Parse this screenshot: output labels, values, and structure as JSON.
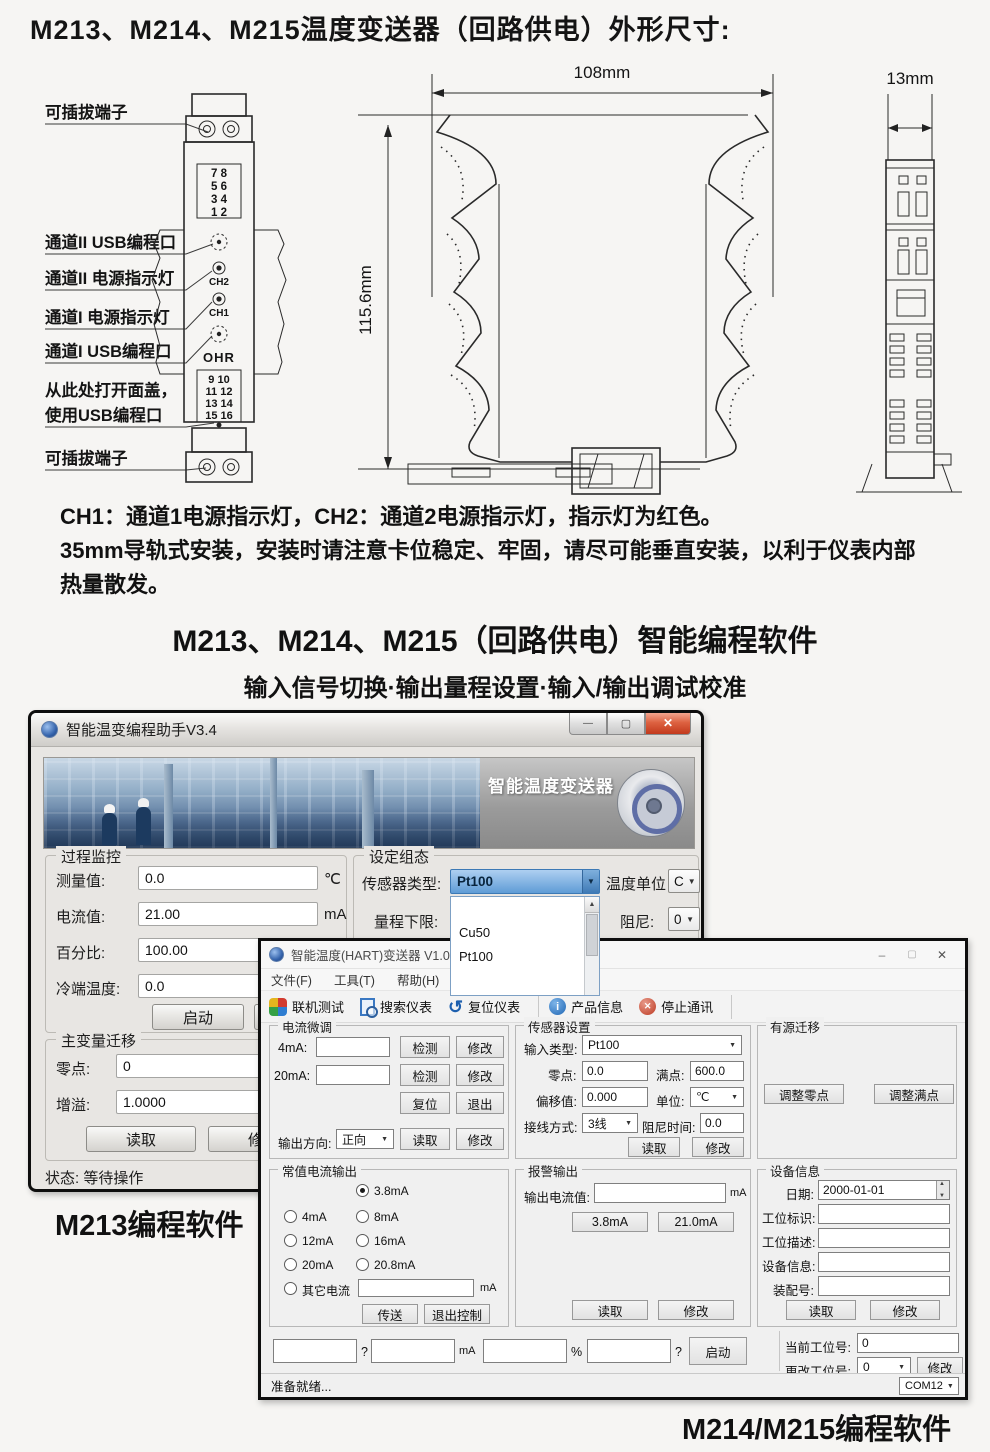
{
  "page": {
    "title": "M213、M214、M215温度变送器（回路供电）外形尺寸:",
    "note_line1": "CH1：通道1电源指示灯，CH2：通道2电源指示灯，指示灯为红色。",
    "note_line2": "35mm导轨式安装，安装时请注意卡位稳定、牢固，请尽可能垂直安装，以利于仪表内部",
    "note_line3": "热量散发。",
    "section_title": "M213、M214、M215（回路供电）智能编程软件",
    "section_subtitle": "输入信号切换·输出量程设置·输入/输出调试校准",
    "caption_m213": "M213编程软件",
    "caption_m214": "M214/M215编程软件"
  },
  "diagram": {
    "labels": {
      "plug_top": "可插拔端子",
      "ch2_usb": "通道II USB编程口",
      "ch2_led": "通道II 电源指示灯",
      "ch1_led": "通道I 电源指示灯",
      "ch1_usb": "通道I USB编程口",
      "cover1": "从此处打开面盖，",
      "cover2": "使用USB编程口",
      "plug_bottom": "可插拔端子"
    },
    "device": {
      "terms_top": [
        "7  8",
        "5  6",
        "3  4",
        "1  2"
      ],
      "ch2": "CH2",
      "ch1": "CH1",
      "logo": "OHR",
      "terms_bottom": [
        "9  10",
        "11 12",
        "13 14",
        "15 16"
      ]
    },
    "dims": {
      "width": "108mm",
      "height": "115.6mm",
      "side": "13mm"
    }
  },
  "win1": {
    "title": "智能温变编程助手V3.4",
    "banner_label": "智能温度变送器",
    "process": {
      "title": "过程监控",
      "rows": [
        {
          "label": "测量值:",
          "value": "0.0",
          "unit": "℃"
        },
        {
          "label": "电流值:",
          "value": "21.00",
          "unit": "mA"
        },
        {
          "label": "百分比:",
          "value": "100.00",
          "unit": "%"
        },
        {
          "label": "冷端温度:",
          "value": "0.0",
          "unit": ""
        }
      ],
      "start": "启动",
      "stop": "停止"
    },
    "config": {
      "title": "设定组态",
      "sensor_label": "传感器类型:",
      "sensor_value": "Pt100",
      "temp_unit_label": "温度单位",
      "temp_unit_value": "C",
      "range_label": "量程下限:",
      "damping_label": "阻尼:",
      "damping_value": "0",
      "list_items": [
        "",
        "Cu50",
        "Pt100"
      ]
    },
    "shift": {
      "title": "主变量迁移",
      "zero_label": "零点:",
      "zero_value": "0",
      "gain_label": "增溢:",
      "gain_value": "1.0000",
      "read": "读取",
      "modify": "修改"
    },
    "status": "状态: 等待操作"
  },
  "win2": {
    "title": "智能温度(HART)变送器 V1.05 (2017-04-07)",
    "menus": [
      "文件(F)",
      "工具(T)",
      "帮助(H)"
    ],
    "toolbar": [
      "联机测试",
      "搜索仪表",
      "复位仪表",
      "产品信息",
      "停止通讯"
    ],
    "trim": {
      "title": "电流微调",
      "l4": "4mA:",
      "l20": "20mA:",
      "detect": "检测",
      "modify": "修改",
      "reset": "复位",
      "exit": "退出",
      "dir_label": "输出方向:",
      "dir_value": "正向",
      "read": "读取"
    },
    "constout": {
      "title": "常值电流输出",
      "o0": "3.8mA",
      "o1": "4mA",
      "o2": "8mA",
      "o3": "12mA",
      "o4": "16mA",
      "o5": "20mA",
      "o6": "20.8mA",
      "other": "其它电流",
      "unit": "mA",
      "send": "传送",
      "exitctl": "退出控制"
    },
    "sensor": {
      "title": "传感器设置",
      "type_label": "输入类型:",
      "type_value": "Pt100",
      "zero_label": "零点:",
      "zero_value": "0.0",
      "full_label": "满点:",
      "full_value": "600.0",
      "offset_label": "偏移值:",
      "offset_value": "0.000",
      "unit_label": "单位:",
      "unit_value": "℃",
      "wire_label": "接线方式:",
      "wire_value": "3线",
      "damp_label": "阻尼时间:",
      "damp_value": "0.0",
      "read": "读取",
      "modify": "修改"
    },
    "alarm": {
      "title": "报警输出",
      "label": "输出电流值:",
      "unit": "mA",
      "low": "3.8mA",
      "high": "21.0mA",
      "read": "读取",
      "modify": "修改"
    },
    "active": {
      "title": "有源迁移",
      "zero": "调整零点",
      "full": "调整满点"
    },
    "device": {
      "title": "设备信息",
      "date_label": "日期:",
      "date_value": "2000-01-01",
      "tag_label": "工位标识:",
      "desc_label": "工位描述:",
      "info_label": "设备信息:",
      "asm_label": "装配号:",
      "read": "读取",
      "modify": "修改"
    },
    "bottom": {
      "sep1": "?",
      "sep2": "mA",
      "sep3": "%",
      "sep4": "?",
      "start": "启动",
      "cur_label": "当前工位号:",
      "cur_value": "0",
      "chg_label": "更改工位号:",
      "chg_value": "0",
      "modify": "修改"
    },
    "status": {
      "ready": "准备就绪...",
      "com": "COM12"
    }
  }
}
